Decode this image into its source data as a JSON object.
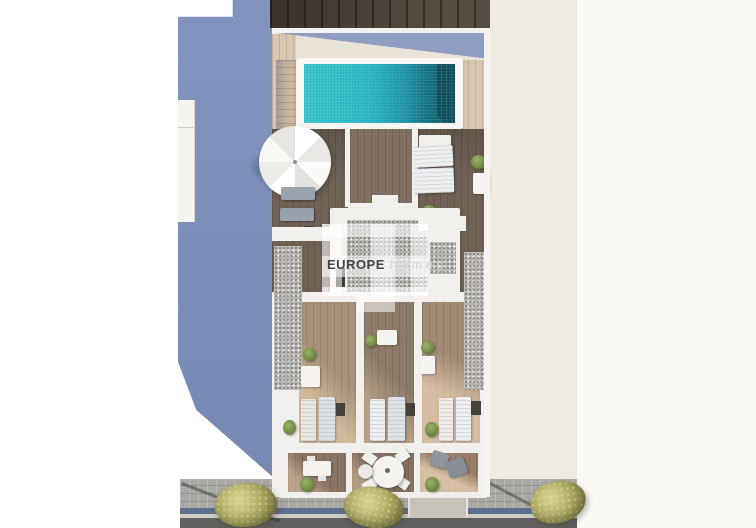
{
  "meta": {
    "type": "3d-aerial-architectural-render",
    "subject": "Top-down render of a penthouse roof terrace with swimming pool, sun decks, three lower terraces and a street with sidewalk trees"
  },
  "watermark": {
    "brand_primary": "EUROPE",
    "brand_secondary": "homes"
  },
  "palette": {
    "pool_water": "#2bb7c1",
    "pool_deep_end": "#115d6d",
    "cast_shadow_blue": "#7d90ba",
    "roof_deck_dark_wood": "#6f6154",
    "pool_deck_light_wood": "#d8c6b0",
    "room_floor_wood": "#a28b75",
    "gravel_roof": "#b6b4af",
    "walls_white": "#f2f0ec",
    "sidewalk_pavers": "#a9a8a4",
    "road_asphalt": "#605f5d",
    "gutter_blue": "#5b6e8c",
    "tree_olive": "#aaa55e",
    "background_left": "#ffffff",
    "background_right_cream": "#efebe3"
  },
  "features": [
    "swimming-pool",
    "pool-stairs",
    "white-parasol",
    "roof-sun-loungers",
    "room-sun-loungers",
    "round-dining-table",
    "terrace-tables",
    "gravel-planters",
    "stairwell-roof",
    "street-trees",
    "sidewalk",
    "road",
    "driveway"
  ]
}
